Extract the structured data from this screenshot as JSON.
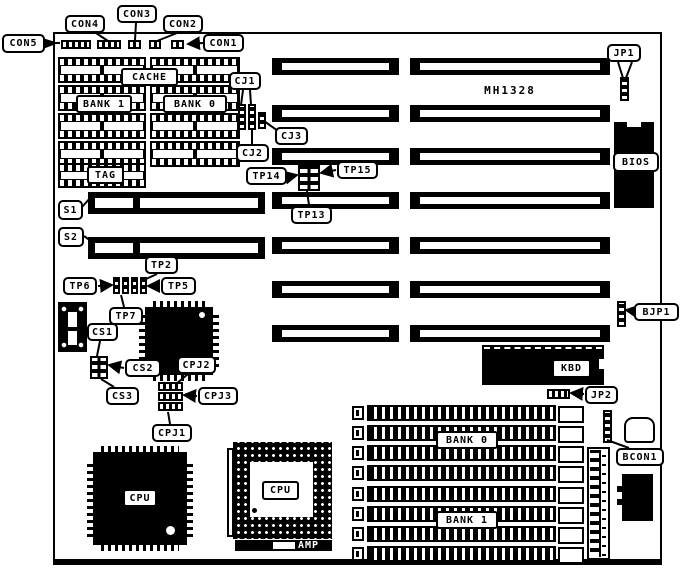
{
  "board": {
    "model": "MH1328",
    "labels": {
      "con1": "CON1",
      "con2": "CON2",
      "con3": "CON3",
      "con4": "CON4",
      "con5": "CON5",
      "cj1": "CJ1",
      "cj2": "CJ2",
      "cj3": "CJ3",
      "jp1": "JP1",
      "jp2": "JP2",
      "bjp1": "BJP1",
      "bcon1": "BCON1",
      "tp2": "TP2",
      "tp5": "TP5",
      "tp6": "TP6",
      "tp7": "TP7",
      "tp13": "TP13",
      "tp14": "TP14",
      "tp15": "TP15",
      "s1": "S1",
      "s2": "S2",
      "cs1": "CS1",
      "cs2": "CS2",
      "cs3": "CS3",
      "cpj1": "CPJ1",
      "cpj2": "CPJ2",
      "cpj3": "CPJ3",
      "cache": "CACHE",
      "cache_bank1": "BANK 1",
      "cache_bank0": "BANK 0",
      "tag": "TAG",
      "bios": "BIOS",
      "kbd": "KBD",
      "cpu_qfp": "CPU",
      "cpu_pga": "CPU",
      "amp": "AMP",
      "simm_bank0": "BANK 0",
      "simm_bank1": "BANK 1"
    },
    "colors": {
      "ink": "#000000",
      "paper": "#ffffff"
    }
  }
}
